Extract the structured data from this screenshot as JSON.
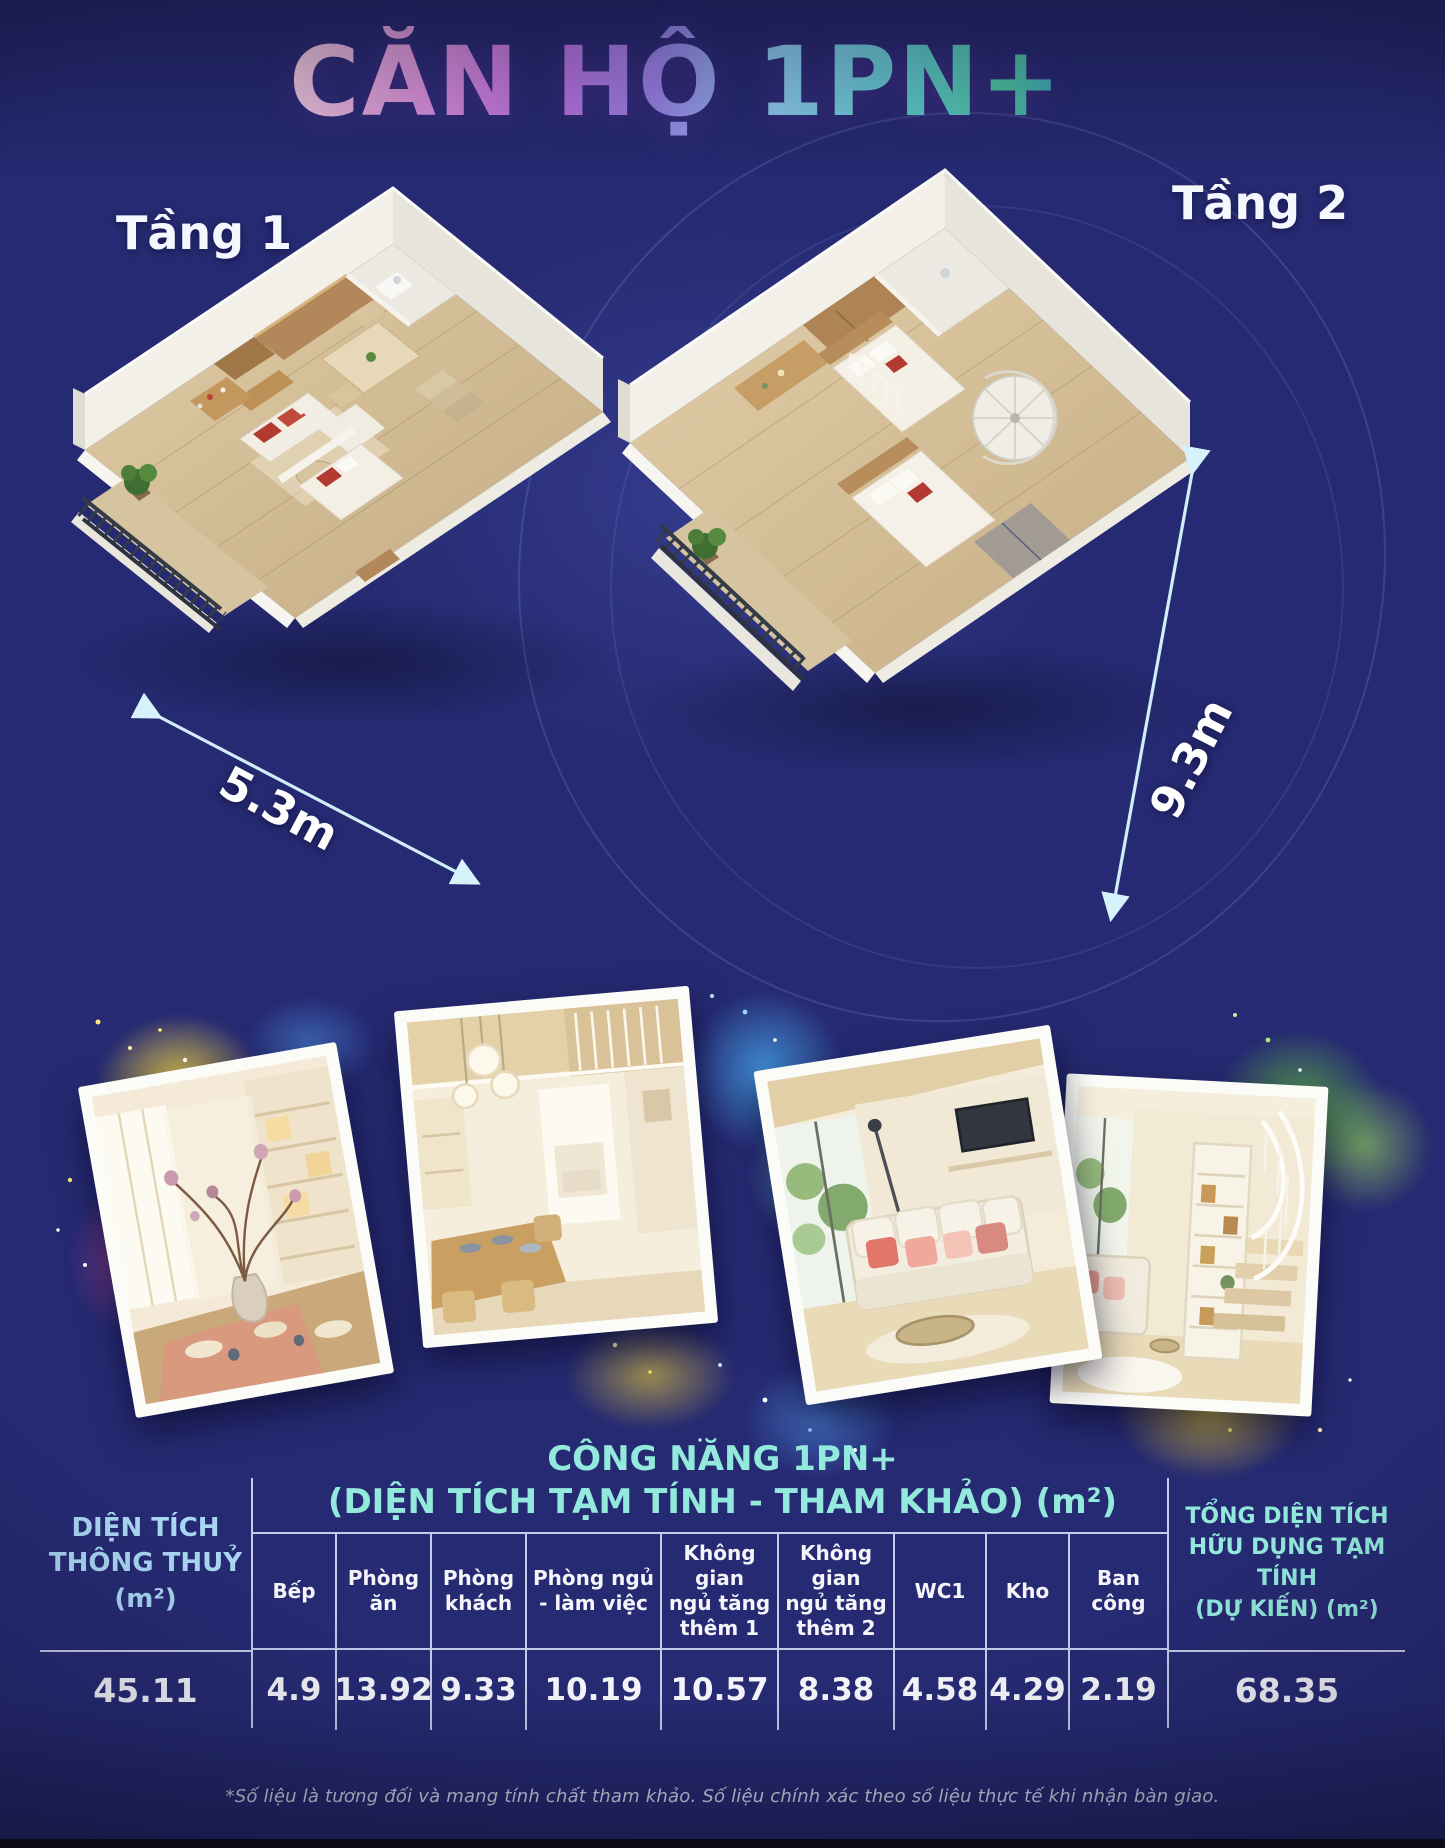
{
  "page": {
    "title": "CĂN HỘ 1PN+"
  },
  "floors": {
    "floor1": {
      "label": "Tầng 1",
      "width_dim": "5.3m"
    },
    "floor2": {
      "label": "Tầng 2",
      "depth_dim": "9.3m"
    }
  },
  "spec_table": {
    "title_line1": "CÔNG NĂNG 1PN+",
    "title_line2": "(DIỆN TÍCH TẠM TÍNH - THAM KHẢO)  (m²)",
    "left": {
      "line1": "DIỆN TÍCH",
      "line2": "THÔNG THUỶ",
      "line3": "(m²)",
      "value": "45.11"
    },
    "right": {
      "line1": "TỔNG DIỆN TÍCH",
      "line2": "HỮU DỤNG TẠM TÍNH",
      "line3": "(DỰ KIẾN) (m²)",
      "value": "68.35"
    },
    "columns": [
      {
        "label": "Bếp",
        "value": "4.9"
      },
      {
        "label": "Phòng\năn",
        "value": "13.92"
      },
      {
        "label": "Phòng\nkhách",
        "value": "9.33"
      },
      {
        "label": "Phòng ngủ\n- làm việc",
        "value": "10.19"
      },
      {
        "label": "Không gian\nngủ tăng\nthêm 1",
        "value": "10.57"
      },
      {
        "label": "Không gian\nngủ tăng\nthêm 2",
        "value": "8.38"
      },
      {
        "label": "WC1",
        "value": "4.58"
      },
      {
        "label": "Kho",
        "value": "4.29"
      },
      {
        "label": "Ban\ncông",
        "value": "2.19"
      }
    ]
  },
  "footer": {
    "note": "*Số liệu là tương đối và mang tính chất tham khảo. Số liệu chính xác theo số liệu thực tế khi nhận bàn giao."
  },
  "colors": {
    "background": "#262a72",
    "table_title": "#93e9db",
    "left_header": "#a9d6f2",
    "arrow": "#cfeef9",
    "value_text": "#f4f4fa"
  }
}
